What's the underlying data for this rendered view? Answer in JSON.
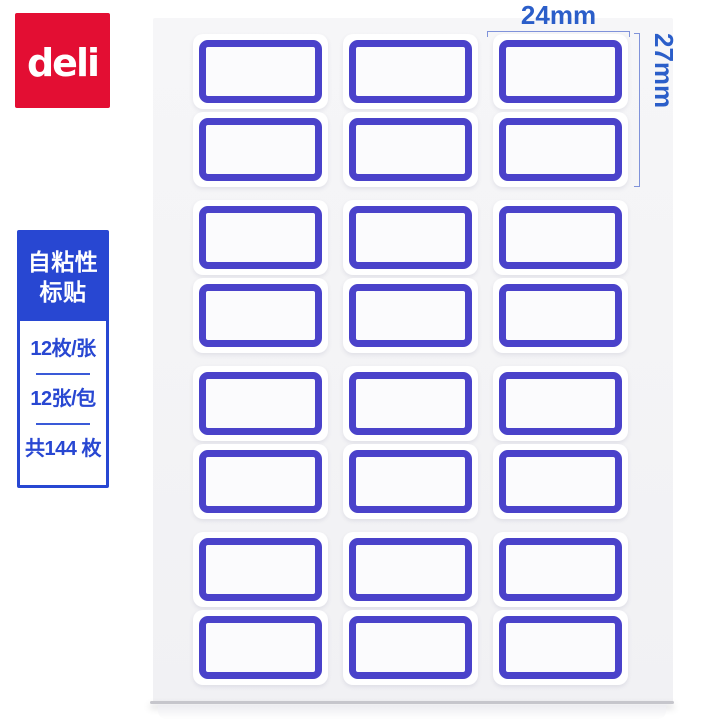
{
  "brand": {
    "logo_text": "deli"
  },
  "info_card": {
    "title_lines": [
      "自粘性",
      "标贴"
    ],
    "specs": [
      "12枚/张",
      "12张/包",
      "共144 枚"
    ]
  },
  "dimensions": {
    "width_label": "24mm",
    "height_label": "27mm"
  },
  "sheet": {
    "grid": {
      "columns": 3,
      "pairs": 4,
      "rows_per_pair": 2
    },
    "visible_labels": 24
  },
  "colors": {
    "brand_red": "#e30e33",
    "info_blue": "#2847d2",
    "dim_text_blue": "#2b5ec9",
    "bracket_blue": "#8093da",
    "label_border": "#4a42ca",
    "label_fill": "#fbfbfd",
    "sheet_bg": "#f4f4f6"
  }
}
